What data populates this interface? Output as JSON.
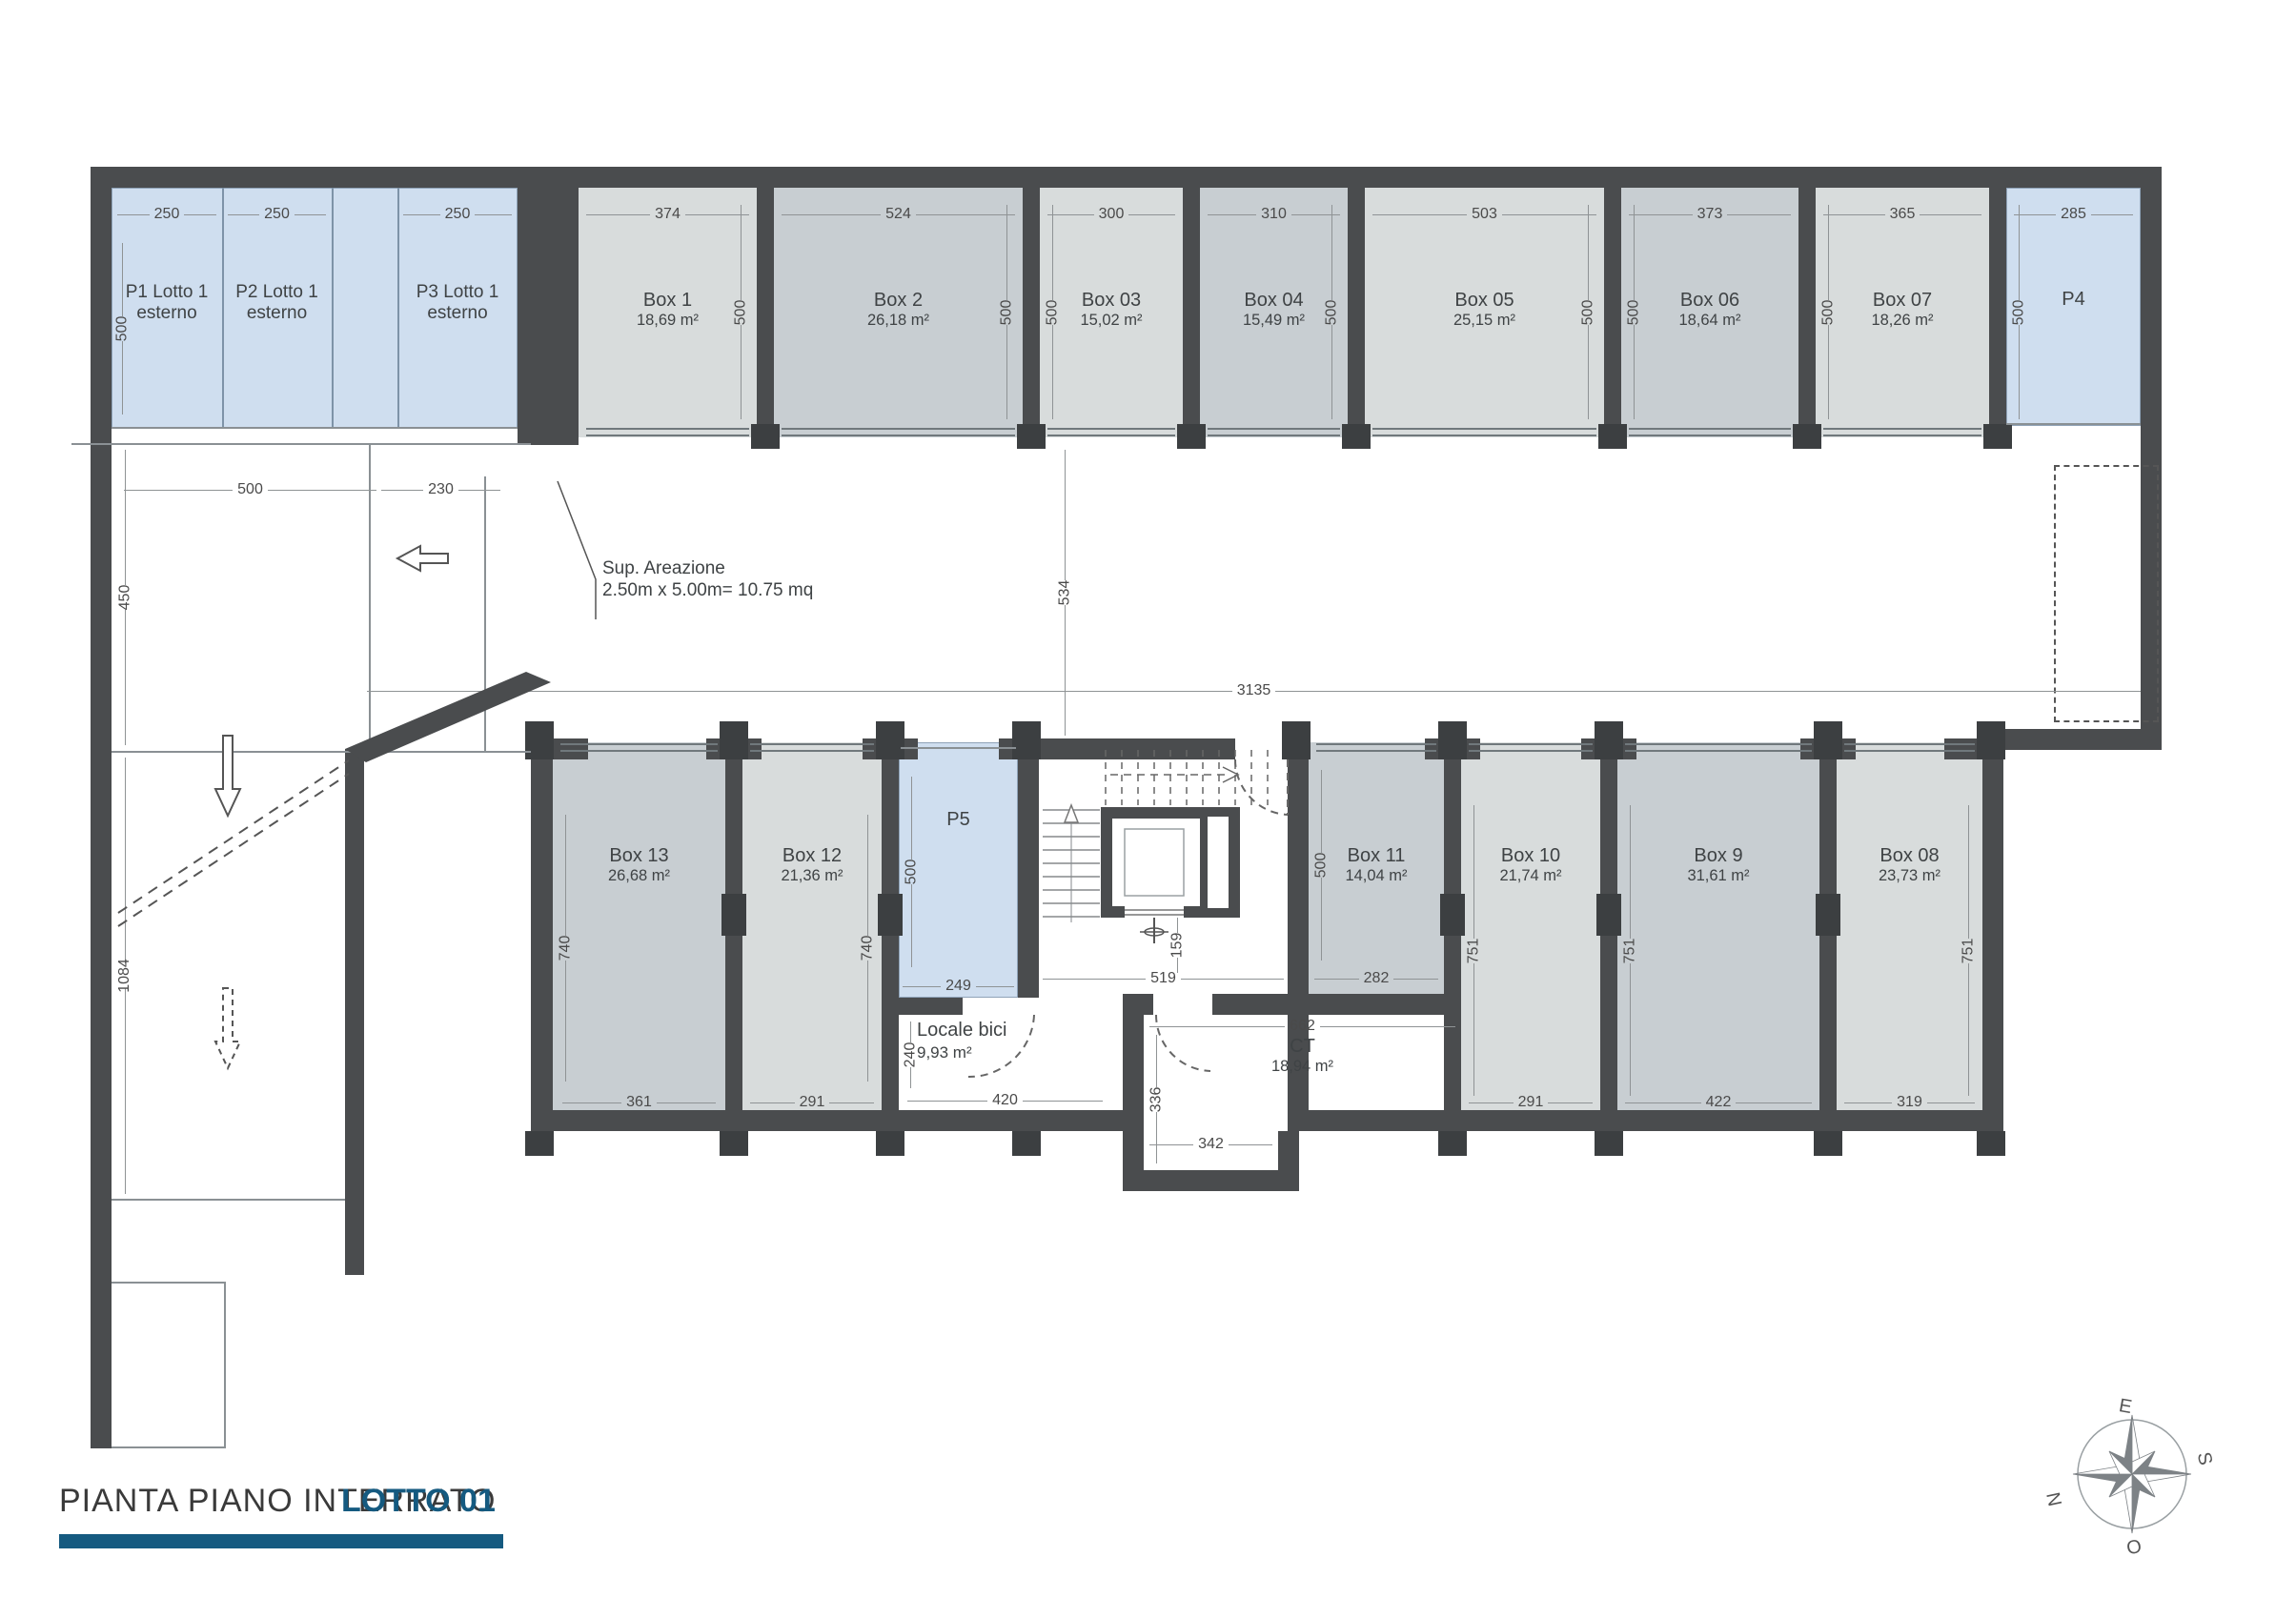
{
  "title": {
    "main": "PIANTA PIANO INTERRATO",
    "lot": "LOTTO 01"
  },
  "colors": {
    "wall": "#4a4c4e",
    "parking_blue": "#cfdeef",
    "box_gray_light": "#d8dcdc",
    "box_gray_mid": "#c8ced2",
    "accent_blue": "#155a80"
  },
  "compass": {
    "top": "E",
    "right": "S",
    "bottom": "O",
    "left": "N"
  },
  "annotations": {
    "vent_line1": "Sup. Areazione",
    "vent_line2": "2.50m x 5.00m= 10.75 mq"
  },
  "dims": {
    "left_w1": "500",
    "left_w2": "230",
    "left_h1": "450",
    "left_h2": "1084",
    "corridor_h": "534",
    "corridor_len": "3135",
    "stair_w": "519",
    "stair_elev": "159"
  },
  "top_row": {
    "p1": {
      "name": "P1 Lotto 1",
      "sub": "esterno",
      "w": "250",
      "h": "500"
    },
    "p2": {
      "name": "P2 Lotto 1",
      "sub": "esterno",
      "w": "250"
    },
    "p3": {
      "name": "P3 Lotto 1",
      "sub": "esterno",
      "w": "250"
    },
    "box1": {
      "name": "Box 1",
      "area": "18,69 m²",
      "w": "374",
      "h": "500"
    },
    "box2": {
      "name": "Box 2",
      "area": "26,18 m²",
      "w": "524",
      "h": "500"
    },
    "box03": {
      "name": "Box 03",
      "area": "15,02 m²",
      "w": "300",
      "h": "500"
    },
    "box04": {
      "name": "Box 04",
      "area": "15,49 m²",
      "w": "310",
      "h": "500"
    },
    "box05": {
      "name": "Box 05",
      "area": "25,15 m²",
      "w": "503",
      "h": "500"
    },
    "box06": {
      "name": "Box 06",
      "area": "18,64 m²",
      "w": "373",
      "h": "500"
    },
    "box07": {
      "name": "Box 07",
      "area": "18,26 m²",
      "w": "365",
      "h": "500"
    },
    "p4": {
      "name": "P4",
      "w": "285",
      "h": "500"
    }
  },
  "bottom_row": {
    "box13": {
      "name": "Box 13",
      "area": "26,68 m²",
      "w": "361",
      "h": "740"
    },
    "box12": {
      "name": "Box 12",
      "area": "21,36 m²",
      "w": "291",
      "h": "740"
    },
    "p5": {
      "name": "P5",
      "w": "249",
      "h": "500"
    },
    "box11": {
      "name": "Box 11",
      "area": "14,04 m²",
      "w": "282",
      "h": "500"
    },
    "box10": {
      "name": "Box 10",
      "area": "21,74 m²",
      "w": "291",
      "h": "751"
    },
    "box9": {
      "name": "Box 9",
      "area": "31,61 m²",
      "w": "422",
      "h": "751"
    },
    "box08": {
      "name": "Box 08",
      "area": "23,73 m²",
      "w": "319",
      "h": "751"
    }
  },
  "rooms": {
    "locale_bici": {
      "name": "Locale bici",
      "area": "9,93 m²",
      "w": "420",
      "h": "240"
    },
    "ct": {
      "name": "CT",
      "area": "18,94 m²",
      "w_top": "662",
      "h": "336",
      "w_bottom": "342"
    }
  }
}
